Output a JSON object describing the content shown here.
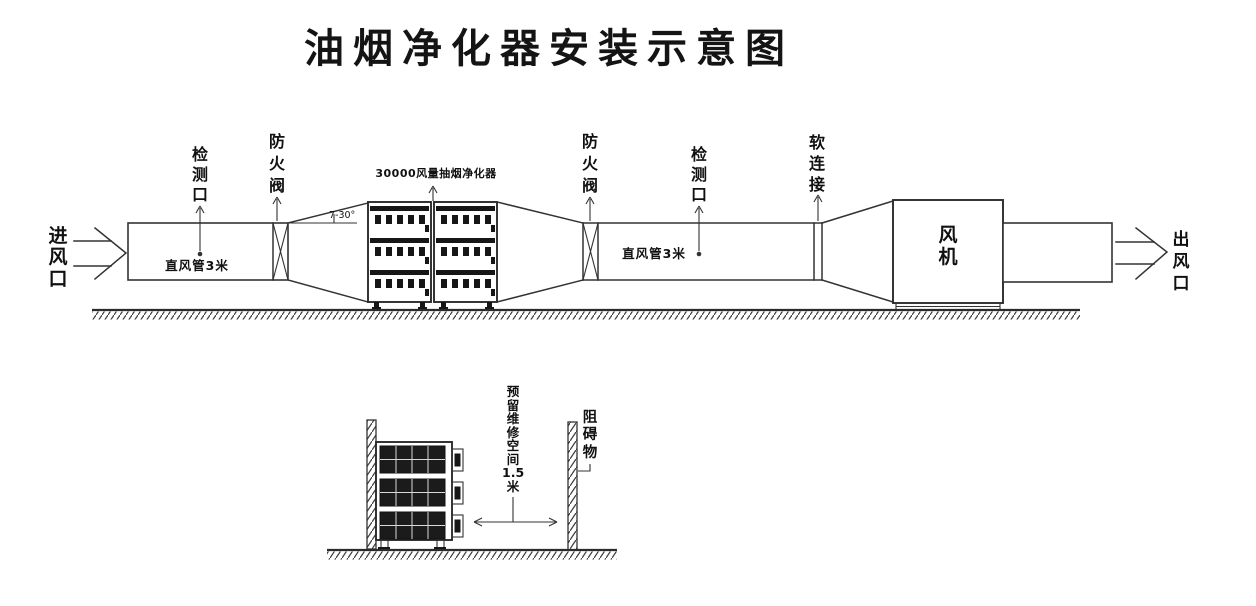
{
  "title": "油烟净化器安装示意图",
  "top_view": {
    "inlet": "进\n风\n口",
    "inspection_left": "检\n测\n口",
    "fire_damper_left": "防\n火\n阀",
    "straight_duct_left": "直风管3米",
    "expansion_angle": "7-30°",
    "purifier": "30000风量抽烟净化器",
    "fire_damper_right": "防\n火\n阀",
    "straight_duct_right": "直风管3米",
    "inspection_right": "检\n测\n口",
    "flexible_connection": "软\n连\n接",
    "fan": "风\n机",
    "outlet": "出\n风\n口"
  },
  "side_view": {
    "maintenance_space": "预\n留\n维\n修\n空\n间\n1.5\n米",
    "obstacle": "阻\n碍\n物"
  },
  "colors": {
    "line": "#333333",
    "text": "#111111",
    "panel": "#1b1b1b",
    "background": "#ffffff"
  }
}
